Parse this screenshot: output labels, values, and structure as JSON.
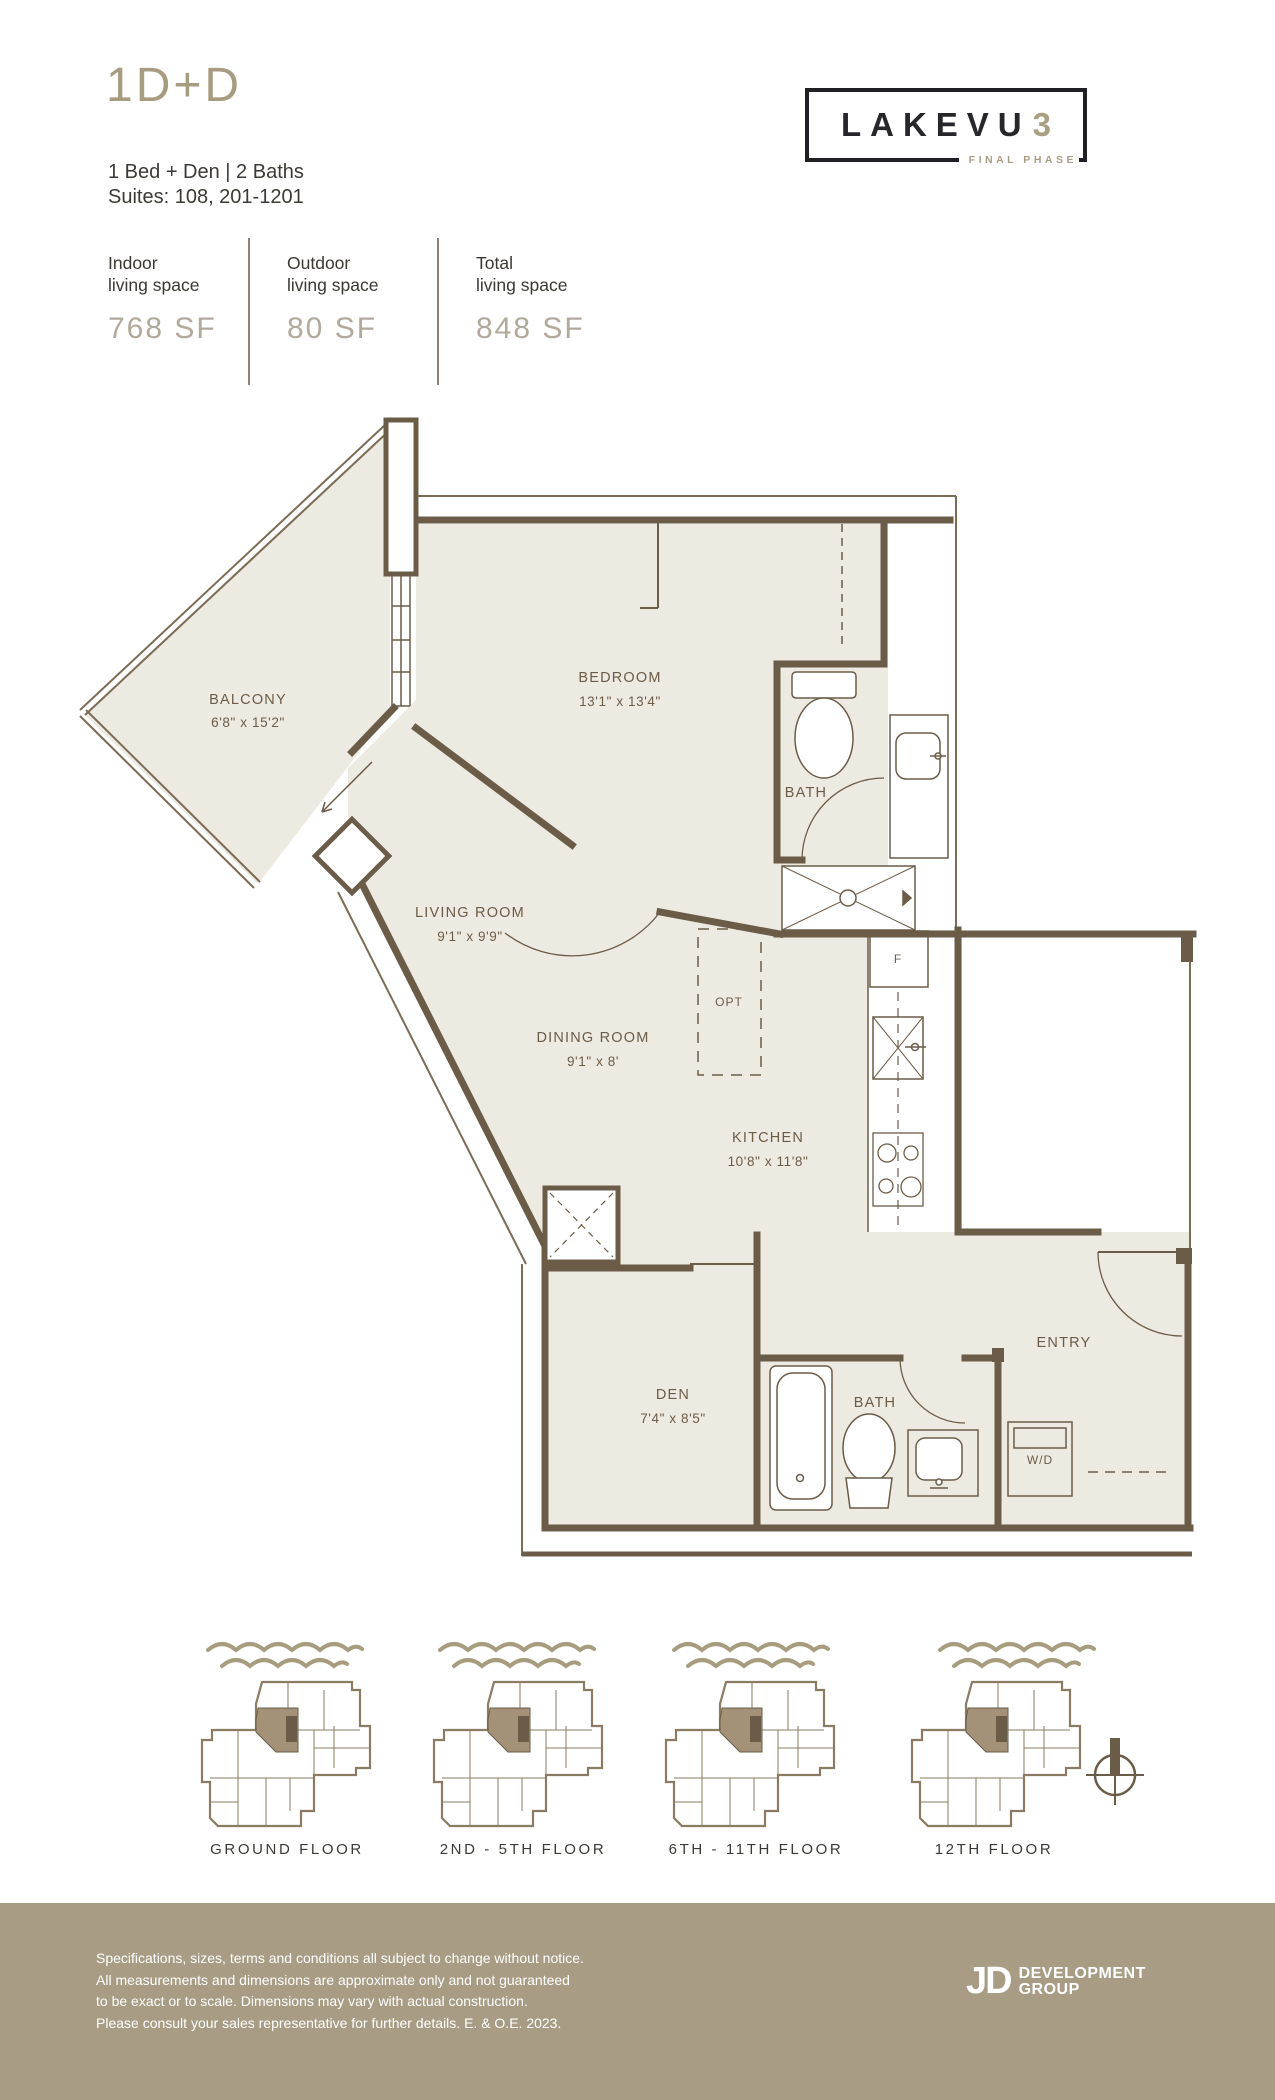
{
  "header": {
    "plan_code": "1D+D",
    "description": "1 Bed + Den | 2 Baths",
    "suites": "Suites: 108, 201-1201"
  },
  "brand": {
    "logo_main": "LAKEVU",
    "logo_number": "3",
    "logo_tagline": "FINAL PHASE"
  },
  "stats": {
    "columns": [
      {
        "label_line1": "Indoor",
        "label_line2": "living space",
        "value": "768 SF"
      },
      {
        "label_line1": "Outdoor",
        "label_line2": "living space",
        "value": "80 SF"
      },
      {
        "label_line1": "Total",
        "label_line2": "living space",
        "value": "848 SF"
      }
    ]
  },
  "floorplan": {
    "rooms": [
      {
        "name": "BALCONY",
        "dims": "6'8\" x 15'2\""
      },
      {
        "name": "BEDROOM",
        "dims": "13'1\" x 13'4\""
      },
      {
        "name": "BATH",
        "dims": ""
      },
      {
        "name": "LIVING ROOM",
        "dims": "9'1\" x 9'9\""
      },
      {
        "name": "DINING ROOM",
        "dims": "9'1\" x 8'"
      },
      {
        "name": "KITCHEN",
        "dims": "10'8\" x 11'8\""
      },
      {
        "name": "DEN",
        "dims": "7'4\" x 8'5\""
      },
      {
        "name": "BATH",
        "dims": ""
      },
      {
        "name": "ENTRY",
        "dims": ""
      }
    ],
    "markers": {
      "optional_island": "OPT",
      "fridge": "F",
      "washer_dryer": "W/D"
    }
  },
  "keyplans": [
    {
      "label": "GROUND FLOOR"
    },
    {
      "label": "2ND - 5TH FLOOR"
    },
    {
      "label": "6TH - 11TH FLOOR"
    },
    {
      "label": "12TH FLOOR"
    }
  ],
  "footer": {
    "disclaimer_lines": [
      "Specifications, sizes, terms and conditions all subject to change without notice.",
      "All measurements and dimensions are approximate only and not guaranteed",
      "to be exact or to scale. Dimensions may vary with actual construction.",
      "Please consult your sales representative for further details. E. & O.E. 2023."
    ],
    "developer": {
      "monogram": "JD",
      "line1": "DEVELOPMENT",
      "line2": "GROUP"
    }
  },
  "colors": {
    "accent_tan": "#a79d7e",
    "wall_brown": "#6b5c48",
    "floor_fill": "#edeae2",
    "footer_band": "#a89c84",
    "logo_black": "#1f1f24"
  }
}
